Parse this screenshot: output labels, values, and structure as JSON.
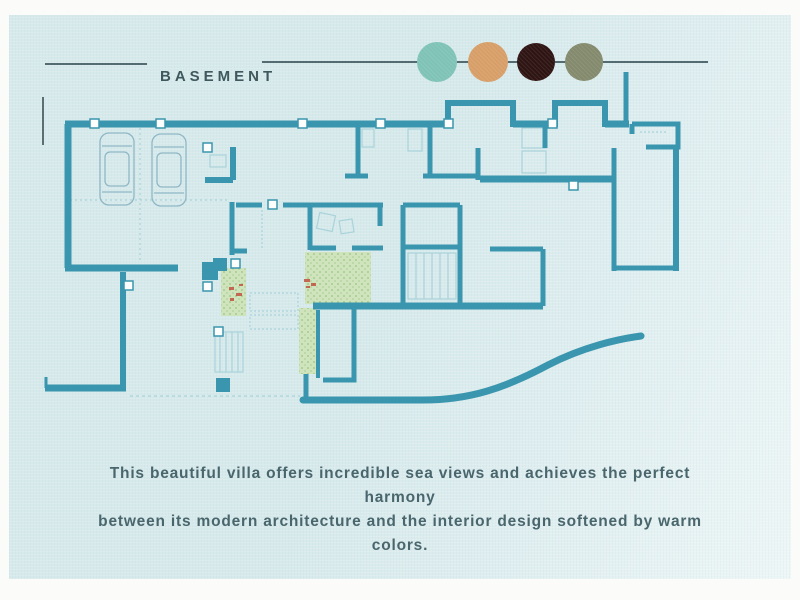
{
  "header": {
    "title": "BASEMENT"
  },
  "palette": {
    "swatches": [
      {
        "name": "teal",
        "hex": "#7fc3b6"
      },
      {
        "name": "terracotta",
        "hex": "#d79e68"
      },
      {
        "name": "dark-brown",
        "hex": "#2e1412"
      },
      {
        "name": "olive",
        "hex": "#848a6d"
      }
    ]
  },
  "caption": {
    "line1": "This beautiful villa offers incredible sea views and achieves the perfect harmony",
    "line2": "between its modern architecture and the interior design softened by warm colors."
  },
  "floorplan": {
    "features": [
      "garage-with-two-cars",
      "interior-rooms",
      "stairs",
      "garden-patches",
      "curved-boundary-wall"
    ]
  },
  "theme": {
    "frame": "#fbfcfa",
    "slide_bg_left": "#d6e9eb",
    "slide_bg_right": "#edf6f6",
    "title": "#3e585e",
    "rule": "#546b72",
    "caption": "#4a666d",
    "wall": "#3a96ae",
    "thin_line": "#a9d3da",
    "vegetation": "#cfe4bc",
    "vegetation_dot": "#a6cb8f",
    "accent_red": "#bf4a38",
    "door_fill": "#fdffff",
    "car_line": "#8fb7c6",
    "tick": "#3d5056"
  }
}
